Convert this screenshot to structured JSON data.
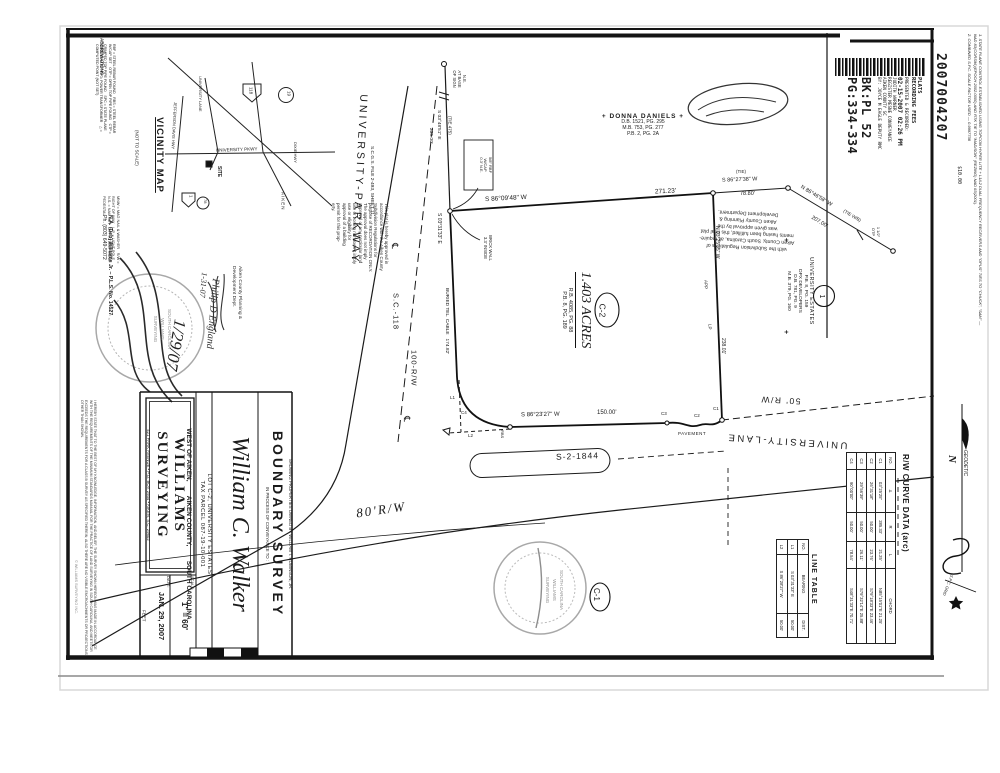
{
  "recording": {
    "doc_number": "2007004207",
    "fee": "$10.00",
    "stamp_lines": [
      "PLATS",
      "RECORDING FEES",
      "PRESENTED & RECORDED:",
      "02-15-2007 02:26 PM",
      "JUDITH WARNER",
      "REGISTER MESNE CONVEYANCE",
      "AIKEN COUNTY SC",
      "BY: JOYCE M EAGLE DEPUTY RMC"
    ],
    "book": "BK:PL 52",
    "page": "PG:334-334"
  },
  "notes": {
    "n1": "1.  STATE PLANE CONTROL ESTABLISHED USING TOPCON HYPER LITE + L1/L2 DUAL FREQUENCY RECEIVERS AND \"OPUS\" TIES TO \"CHUCK\", \"SAM\" — NAD 83(CORS96)(EPOCH 2002.0000) AND RTK TIE TO \"MADISON\" (REZING) NAD 83(2001).",
    "n2": "2.  COMBINED S.P.C. SCALE FACTOR USED — 0.9997738"
  },
  "vicinity": {
    "title": "VICINITY MAP",
    "not_to_scale": "(NOT TO SCALE)",
    "jefferson": "JEFFERSON DAVIS HWY",
    "pkwy": "UNIVERSITY PKWY",
    "lane": "UNIVERSITY LANE",
    "site": "SITE",
    "dixie": "DIXIE HWY",
    "aiken": "AIKEN",
    "shield_118": "118",
    "shield_19": "19",
    "shield_1": "1",
    "shield_78": "78"
  },
  "abbreviations": {
    "title": "ABBREVIATIONS :",
    "col1": "RBF = STEEL REBAR FOUND  RBS = STEEL REBAR W/CAP SET  OTP = OPEN TOP PIPE FOUND  CTP = CRIMPED TOP PIPE FOUND  SPC = STATE PLANE COORDINATE  PP = POWER TRANSFORMER  △ = COMPUTED POINT (NOT SET)",
    "col2": "MNW = MAG NAIL & WASHER  R/W = RIGHT OF WAY  L.P. = LIGHT POLE  N.S. = NAIL SET  T.P. = TELEPHONE PEDESTAL"
  },
  "approval_left": {
    "l0": "This  plat  is  hereby  approved  in",
    "l1": "accordance  with  the  Aiken  County",
    "l2": "Subdivision    Regulations    for",
    "l3": "purpose  of  RECORDATION  ONLY.",
    "l4": "The   approval   does   not   imply",
    "l5": "approval  of  any  particular  land",
    "l6": "use  or  zoning  nor  does  it  imply",
    "l7": "use   or   eligibility   for",
    "l8": "approval  of  a  building",
    "l9": "permit  for  this  prop-",
    "l10": "erty.",
    "dept1": "Aiken County Planning &",
    "dept2": "Development Dept.",
    "sig": "Philip D England",
    "sig_date": "1-31-07",
    "hand_date": "1/29/07"
  },
  "approval_right": {
    "l0": "with the Subdivision Regulations of",
    "l1": "Aiken County, South Carolina, all require-",
    "l2": "ments having been fulfilled, this final plat",
    "l3": "was given approval by the",
    "l4": "Aiken County Planning &",
    "l5": "Development Department."
  },
  "certification": {
    "text": "I HEREBY STATE THAT TO THE BEST OF MY KNOWLEDGE, INFORMATION, AND BELIEF, THE SURVEY SHOWN HEREON WAS MADE IN ACCORDANCE WITH THE REQUIREMENTS OF THE MINIMUM STANDARDS MANUAL FOR THE PRACTICE OF LAND SURVEYING IN SOUTH CAROLINA, AND MEETS OR EXCEEDS THE REQUIREMENTS FOR A CLASS B SURVEY AS SPECIFIED THEREIN; ALSO THERE ARE NO VISIBLE ENCROACHMENTS OR PROJECTIONS OTHER THAN SHOWN.",
    "surveyor": "N.A. (Deb) Williams Jr.  –  P.L.S. No. 14527",
    "phone": "Ph. (803) 649-5072",
    "copyright": "© WILLIAMS SURVEYING INC."
  },
  "parcel": {
    "area": "1.403 ACRES",
    "ref1": "R.B. 4085, PG. 88",
    "ref2": "P.B. 8, PG. 189",
    "label": "C-2"
  },
  "adjoiners": {
    "cross": "+",
    "north_name": "DONNA DANIELS",
    "north_ref1": "D.B. 1521, PG. 295",
    "north_ref2": "M.B. 753, PG. 277",
    "north_ref3": "P.B. 2, PG. 2A",
    "east_name": "UNIVERSITY ESTATES",
    "east_ref1": "P.B. 8, PG. 159",
    "east_name2": "DPX DEVELOPERS",
    "east_ref2": "D.B. 781, PG. 9",
    "east_ref3": "M.B. 379, PG. 160",
    "east_label": "1"
  },
  "bearings": {
    "top_bearing": "S 86°09'48\" W",
    "top_dist": "271.23'",
    "left_bearing": "S 03°31'33\" E",
    "left_note": "BURIED TEL. CABLE   174.82'",
    "right_bearing": "N 03°25'35\" W",
    "right_dist": "238.01'",
    "bottom_bearing": "S 86°23'27\" W",
    "bottom_dist": "150.00'",
    "tie_top_bearing": "S 03°48'51\" E",
    "tie_top_dist": "235.00'",
    "tie_top_label": "(TIE 475)",
    "tie1_label": "(TIE)",
    "tie1_bearing": "S 86°27'38\" W",
    "tie1_dist": "78.80'",
    "tie2_bearing": "N 86°46'58\" W",
    "tie2_dist": "207.00'",
    "tie2_label": "(TIE W/B)"
  },
  "point_labels": {
    "sign1": "N.E.",
    "sign2": "AT BASE",
    "sign3": "OF SIGN",
    "brick1": "BRICK WALL",
    "brick2": "3.3' INSIDE",
    "boxA1": "5/8\" RBF",
    "boxA2": "W/CAP",
    "boxA3": "0.3' N.E.",
    "otp1": "1 1/2\"",
    "otp2": "OTP",
    "app": "APP",
    "lp": "LP",
    "rbs": "RBS",
    "c1": "C1",
    "c2": "C2",
    "c3": "C3",
    "c4": "C4",
    "l1": "L1",
    "l2": "L2",
    "c1_circle": "C-1"
  },
  "roads": {
    "parkway": "UNIVERSITY-PARKWAY",
    "sc118": "S.C.-118",
    "rw100": "100-R/W",
    "lane": "UNIVERSITY-LANE",
    "s2": "S-2-1844",
    "rw80": "80'R/W",
    "rw50": "50' R/W",
    "pavement": "PAVEMENT",
    "cl": "℄",
    "file_note": "S.C.G.S. FILE 2-493, SHEET 11."
  },
  "north": {
    "n": "N",
    "geodetic": "GEODETIC",
    "grid": "S.P.C. GRID"
  },
  "curve_table": {
    "title": "R/W CURVE DATA (arc)",
    "headers": [
      "NO.",
      "Δ",
      "R",
      "L",
      "CHORD"
    ],
    "rows": [
      [
        "C1",
        "03°25'25\"",
        "285.33'",
        "21.25'",
        "N85°15'01\"E   21.25'"
      ],
      [
        "C2",
        "26°31'18\"",
        "50.00'",
        "23.76'",
        "S79°18'33\"E   23.46'"
      ],
      [
        "C3",
        "29°56'39\"",
        "50.00'",
        "26.11'",
        "S79°32'14\"E   25.88'"
      ],
      [
        "C4",
        "90°00'00\"",
        "50.00'",
        "78.54'",
        "S48°31'33\"E   70.71'"
      ]
    ]
  },
  "line_table": {
    "title": "LINE TABLE",
    "headers": [
      "NO.",
      "BEARING",
      "DIST."
    ],
    "rows": [
      [
        "L1",
        "S 03°31'33\" E",
        "50.00'"
      ],
      [
        "L2",
        "S 86°28'27\" W",
        "50.00'"
      ]
    ]
  },
  "title_block": {
    "showing": "SHOWING PROPERTIES OWNED BY WILLIAM T. ROBINSON, JR.",
    "survey_type": "BOUNDARY SURVEY",
    "conveyance": "IN PROCESS OF CONVEYANCE TO :",
    "client": "William C. Walker",
    "lot": "LOT C-2,  UNIVERSITY ESTATES",
    "tax": "TAX PARCEL 087-19-10-001",
    "location": "WEST OF AIKEN,        AIKEN COUNTY,        SOUTH CAROLINA",
    "firm": "WILLIAMS  SURVEYING",
    "address": "421 PARK AVENUE  •  P.O. BOX 2934  •  AIKEN, S.C. 29802",
    "scale_label": "SCALE:",
    "scale": "1\" = 60'",
    "date_label": "DATE:",
    "date": "JAN. 29, 2007",
    "feet": "FEET"
  },
  "seals": {
    "sc": "SOUTH CAROLINA",
    "firm1": "WILLIAMS",
    "firm2": "SURVEYING"
  }
}
